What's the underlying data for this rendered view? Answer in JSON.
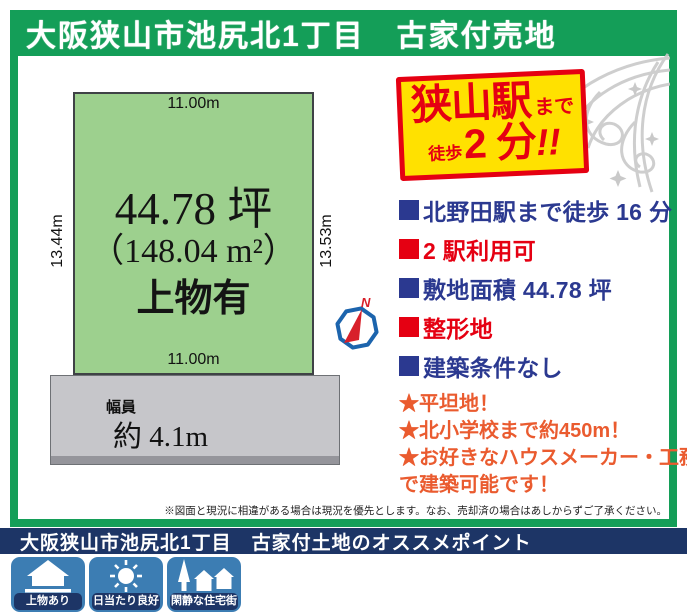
{
  "header": {
    "title": "大阪狭山市池尻北1丁目　古家付売地"
  },
  "plot": {
    "top_length": "11.00m",
    "bottom_length": "11.00m",
    "left_length": "13.44m",
    "right_length": "13.53m",
    "area_tsubo": "44.78 坪",
    "area_sqm": "（148.04 m²）",
    "note": "上物有"
  },
  "road": {
    "label": "幅員",
    "width": "約 4.1m"
  },
  "compass": {
    "north_label": "N"
  },
  "badge": {
    "station": "狭山駅",
    "made": "まで",
    "toho": "徒歩",
    "minutes": "2 分",
    "bang": "!!"
  },
  "bullets": [
    {
      "text": "北野田駅まで徒歩 16 分",
      "color": "#2b3990"
    },
    {
      "text": "2 駅利用可",
      "color": "#e50012"
    },
    {
      "text": "敷地面積 44.78 坪",
      "color": "#2b3990"
    },
    {
      "text": "整形地",
      "color": "#e50012"
    },
    {
      "text": "建築条件なし",
      "color": "#2b3990"
    }
  ],
  "stars": [
    "★平坦地！",
    "★北小学校まで約450m！",
    "★お好きなハウスメーカー・工務店",
    "で建築可能です！"
  ],
  "disclaimer": "※図面と現況に相違がある場合は現況を優先とします。なお、売却済の場合はあしからずご了承ください。",
  "footer": {
    "title": "大阪狭山市池尻北1丁目　古家付土地のオススメポイント"
  },
  "feature_icons": [
    {
      "icon": "house-icon",
      "label": "上物あり"
    },
    {
      "icon": "sun-icon",
      "label": "日当たり良好"
    },
    {
      "icon": "quiet-street-icon",
      "label": "閑静な住宅街"
    }
  ],
  "colors": {
    "header_green": "#149e58",
    "plot_green": "#9dd08e",
    "road_gray": "#c6c6ca",
    "navy": "#2b3990",
    "red": "#e50012",
    "star_orange": "#ea5b2f",
    "badge_yellow": "#ffe100",
    "footer_navy": "#1d3566",
    "tile_blue": "#3c7db3"
  }
}
